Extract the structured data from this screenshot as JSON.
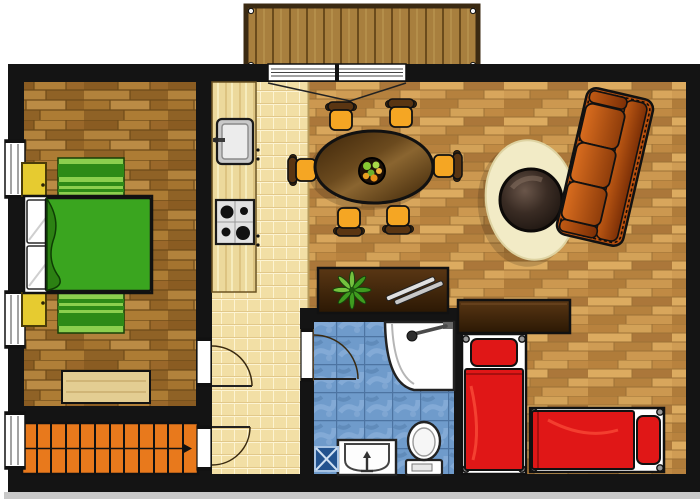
{
  "meta": {
    "title": "Apartment Floor Plan",
    "description": "Top-down furnished floor plan; no text labels visible in the drawing"
  },
  "colors": {
    "background": "#ffffff",
    "wall": "#141414",
    "bedroom_floor_wood": "#a1702e",
    "living_floor_wood": "#c5914a",
    "kitchen_tile": "#f2dfa5",
    "bathroom_tile": "#6f9bcb",
    "balcony_deck": "#a87f3e",
    "stairs": "#e8791c",
    "bed_blanket": "#3aa51f",
    "bed_rug_light": "#8ccf4e",
    "bed_rug_dark": "#2e8a17",
    "nightstand": "#e6cb30",
    "bench_wood": "#e3cd92",
    "counter_wood": "#ecd99c",
    "dining_chair": "#f5a623",
    "area_rug": "#f2ebc6",
    "sofa": "#b8500f",
    "red_bed": "#e01717",
    "dark_furniture": "#4e2f12",
    "fixture_white": "#ffffff",
    "drain_blue": "#23538f"
  },
  "rooms": [
    {
      "id": "bedroom",
      "label": "Bedroom with double bed",
      "floor": "dark wood planks"
    },
    {
      "id": "kitchen-hall",
      "label": "Kitchen and hallway strip",
      "floor": "cream tiles"
    },
    {
      "id": "living-dining",
      "label": "Living / dining room",
      "floor": "light wood planks"
    },
    {
      "id": "bathroom",
      "label": "Bathroom",
      "floor": "blue tiles"
    },
    {
      "id": "sleeping-area",
      "label": "Sleeping area with two single beds",
      "floor": "light wood planks"
    },
    {
      "id": "staircase",
      "label": "Staircase corridor",
      "floor": "orange steps"
    },
    {
      "id": "balcony",
      "label": "Balcony deck",
      "floor": "wood decking"
    }
  ],
  "furniture": [
    {
      "item": "double-bed-green",
      "room": "bedroom",
      "count": 1
    },
    {
      "item": "nightstand-yellow",
      "room": "bedroom",
      "count": 2
    },
    {
      "item": "striped-green-rug",
      "room": "bedroom",
      "count": 2
    },
    {
      "item": "wood-bench",
      "room": "bedroom",
      "count": 1
    },
    {
      "item": "kitchen-counter",
      "room": "kitchen-hall",
      "count": 1
    },
    {
      "item": "kitchen-sink",
      "room": "kitchen-hall",
      "count": 1
    },
    {
      "item": "stove-four-burners",
      "room": "kitchen-hall",
      "count": 1
    },
    {
      "item": "oval-dining-table",
      "room": "living-dining",
      "count": 1
    },
    {
      "item": "dining-chair",
      "room": "living-dining",
      "count": 6
    },
    {
      "item": "fruit-bowl",
      "room": "living-dining",
      "count": 1
    },
    {
      "item": "oval-area-rug",
      "room": "living-dining",
      "count": 1
    },
    {
      "item": "round-coffee-table",
      "room": "living-dining",
      "count": 1
    },
    {
      "item": "three-seat-sofa",
      "room": "living-dining",
      "count": 1
    },
    {
      "item": "sideboard-with-plant-and-magazines",
      "room": "living-dining",
      "count": 1
    },
    {
      "item": "wardrobe",
      "room": "sleeping-area",
      "count": 1
    },
    {
      "item": "single-bed-red",
      "room": "sleeping-area",
      "count": 2
    },
    {
      "item": "corner-shower",
      "room": "bathroom",
      "count": 1
    },
    {
      "item": "toilet",
      "room": "bathroom",
      "count": 1
    },
    {
      "item": "washbasin",
      "room": "bathroom",
      "count": 1
    },
    {
      "item": "floor-drain",
      "room": "bathroom",
      "count": 1
    }
  ],
  "openings": {
    "windows_left_wall": 3,
    "interior_hinged_doors": 3,
    "balcony_sliding_door_panels": 2,
    "stairs_steps": 12
  }
}
